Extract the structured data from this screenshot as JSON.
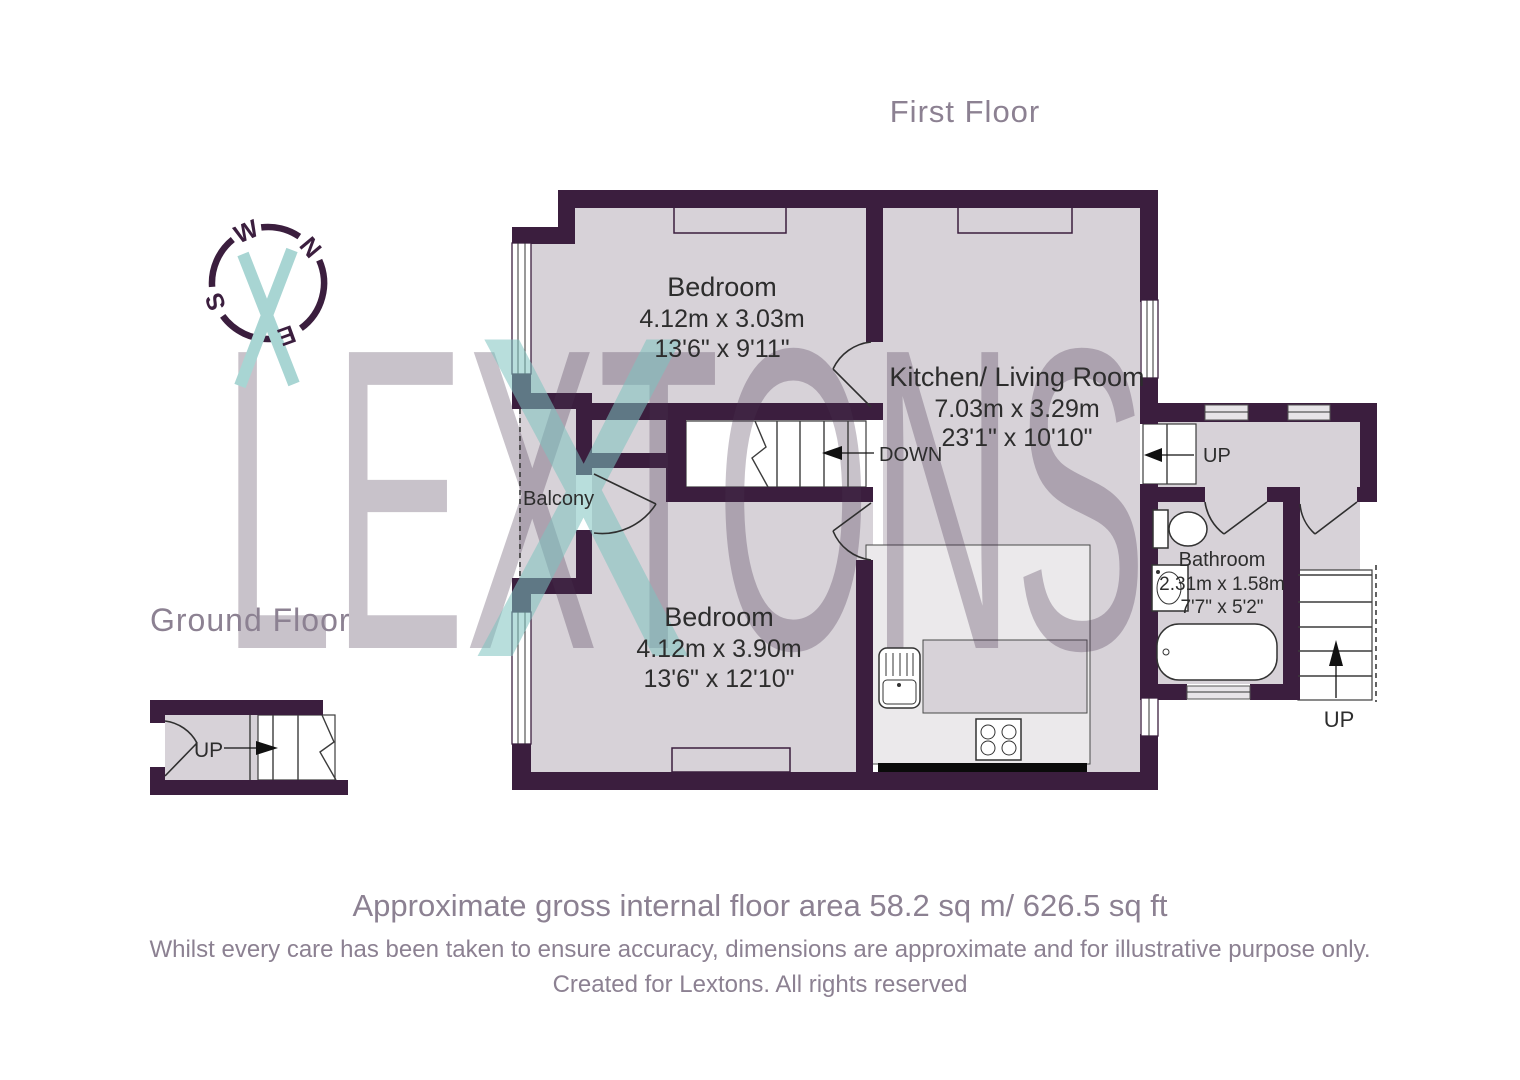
{
  "titles": {
    "first_floor": "First Floor",
    "ground_floor": "Ground Floor"
  },
  "compass": {
    "n": "N",
    "e": "E",
    "s": "S",
    "w": "W"
  },
  "watermark": {
    "word": "LEXTONS",
    "x_mark": "X"
  },
  "rooms": {
    "bedroom_front": {
      "name": "Bedroom",
      "metric": "4.12m x 3.03m",
      "imperial": "13'6\" x 9'11\""
    },
    "kitchen_living": {
      "name": "Kitchen/ Living Room",
      "metric": "7.03m x 3.29m",
      "imperial": "23'1\" x 10'10\""
    },
    "bedroom_back": {
      "name": "Bedroom",
      "metric": "4.12m x 3.90m",
      "imperial": "13'6\" x 12'10\""
    },
    "bathroom": {
      "name": "Bathroom",
      "metric": "2.31m x 1.58m",
      "imperial": "7'7\" x 5'2\""
    },
    "balcony": {
      "name": "Balcony"
    }
  },
  "stair_labels": {
    "down": "DOWN",
    "up_hall": "UP",
    "up_external": "UP",
    "up_ground": "UP"
  },
  "footer": {
    "area_line": "Approximate gross internal floor area 58.2 sq m/ 626.5 sq ft",
    "disclaimer": "Whilst every care has been taken to ensure accuracy, dimensions are approximate and for illustrative purpose only.",
    "credit": "Created for Lextons. All rights reserved"
  },
  "colors": {
    "wall": "#3b1e3e",
    "room_fill": "#d7d2d8",
    "kitchen_floor": "#ebe9eb",
    "accent_teal": "#a8d5d3",
    "heading_text": "#8c8192",
    "label_text": "#2d2d2d"
  }
}
